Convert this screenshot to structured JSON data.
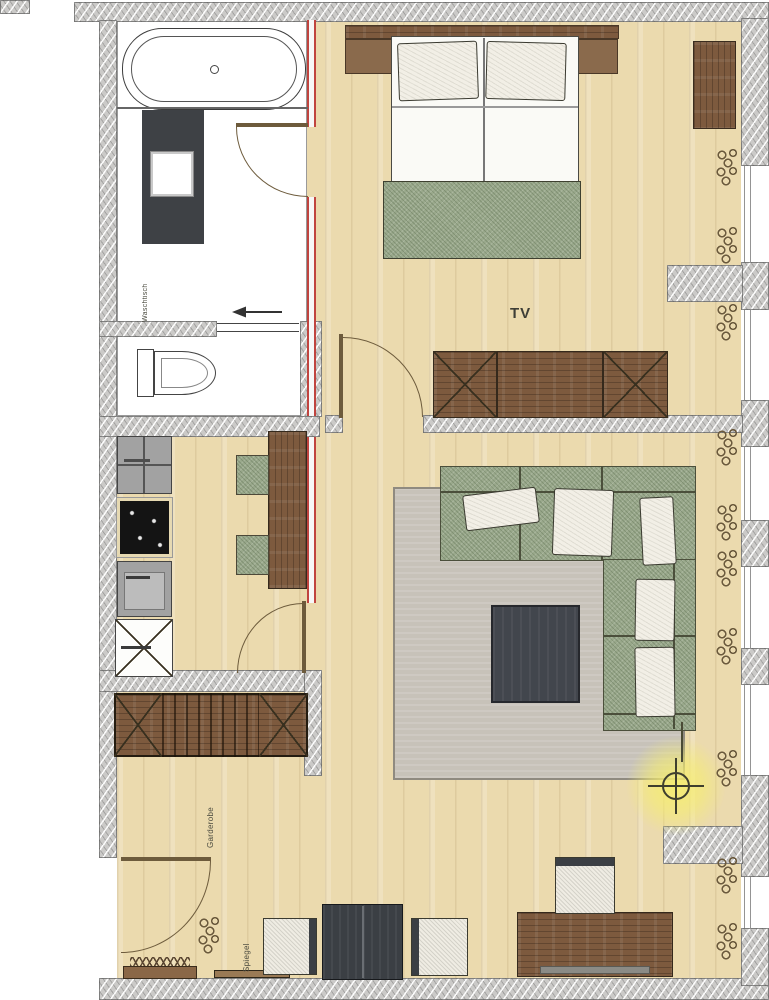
{
  "plan": {
    "labels": {
      "tv": "TV",
      "garderobe": "Garderobe",
      "spiegel": "Spiegel",
      "waschtisch": "Waschtisch"
    },
    "colors": {
      "wall_hatch_gray": "#cbcac8",
      "floor_wood": "#ebdaae",
      "glass_partition_red": "#c0443f",
      "sofa_green": "#9aa98c",
      "furniture_brown": "#7d5a3e",
      "dark_furniture_charcoal": "#3e4247",
      "rug_gray": "#c7c2b9",
      "lamp_glow_yellow": "#f6ee6e",
      "appliance_gray": "#a2a2a2",
      "cooktop_black": "#141414"
    },
    "icons": {
      "lamp": "ceiling-light-icon",
      "radiator": "radiator-icon",
      "wc_arrow": "left-arrow-icon"
    }
  }
}
